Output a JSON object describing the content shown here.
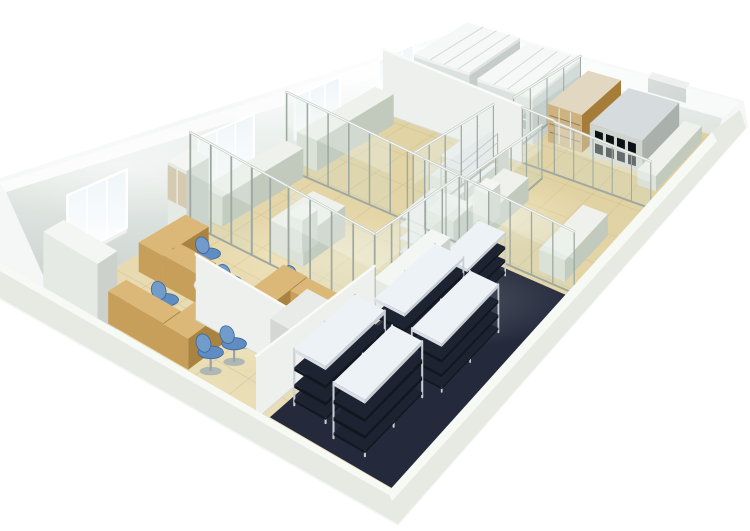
{
  "meta": {
    "title": "3D laboratory floor plan rendering",
    "description": "Isometric cutaway 3D rendering of a long rectangular laboratory suite: office area with wooden desks and blue swivel chairs at the near end, glass-partitioned lab rooms with white benches in the middle, storage room with shelving racks on dark flooring at the front, and fume hoods with reagent cabinets in the far room. White outer walls with windows, beige tiled floor."
  },
  "palette": {
    "background": "#ffffff",
    "shell": "#f5f7f6",
    "wallTopStrip": "#fafbfa",
    "frontWall": "#e4e7df",
    "frontWallStrip": "#f6f8f4",
    "grout": "#c9bc8e",
    "darkFloor": "#242a3c",
    "glass": "rgba(198,219,211,0.20)",
    "glassHighlight": "rgba(255,255,255,0.25)",
    "alum": "#9fa9a1",
    "alumLight": "#ccd3cb",
    "windowPaneTop": "#eef5f9",
    "windowFrame": "#ffffff",
    "windowSill": "#eff2ee",
    "mats": {
      "counter": {
        "top": "#eef1ec",
        "front": "#dfe4da",
        "side": "#c2c9bd"
      },
      "white": {
        "top": "#f4f6f3",
        "front": "#e6eae4",
        "side": "#ccd2cb"
      },
      "wood": {
        "top": "#dcb878",
        "front": "#c79e5a",
        "side": "#a9833f"
      },
      "granite": {
        "top": "#e9ebe9",
        "front": "#d4d7d4",
        "side": "#bec2be"
      },
      "red": {
        "top": "#d84f3a",
        "front": "#bb2d1d",
        "side": "#8f1f13"
      },
      "hood": {
        "top": "#edf0ef",
        "front": "#dce2e0",
        "side": "#c5ccca"
      },
      "woodcab": {
        "top": "#e2d7c0",
        "front": "#c49a52",
        "side": "#a57d38"
      },
      "darkcab": {
        "top": "#d6dbdd",
        "front": "#cfd4cf",
        "side": "#aab0ab"
      },
      "wall": {
        "face": "#eef0ed"
      }
    },
    "rack": {
      "post": "#c6ced6",
      "dark": "#1d2331",
      "darkFront": "#12161f",
      "top": "#edf2f6",
      "topFront": "#d9dfe4"
    },
    "shelf": {
      "post": "#aeb6af",
      "slabTop": "#eceff0",
      "slabFront": "#d7ddda",
      "slabSide": "#c3cac6"
    },
    "chair": {
      "seat": "#5f8cc2",
      "back": "#719bcb",
      "rim": "#3e6598",
      "base": "#a9b2b4",
      "post": "#98a2a2"
    },
    "compartment": "#0d1014"
  },
  "scene": {
    "quad": {
      "L": [
        55,
        302
      ],
      "T": [
        465,
        66
      ],
      "R": [
        716,
        136
      ],
      "B": [
        390,
        498
      ]
    },
    "scale": {
      "k0": 46,
      "ks": 26,
      "kt": 6
    },
    "tiles": {
      "long": 14,
      "cross": 10
    },
    "dark_floor": {
      "s1": 0.02,
      "t1": 0.62,
      "s2": 0.555,
      "t2": 1.0
    },
    "windows": [
      {
        "n": "window-1",
        "s1": 0.03,
        "s2": 0.175,
        "h1": 0.8,
        "h2": 2.2
      },
      {
        "n": "window-2",
        "s1": 0.35,
        "s2": 0.485,
        "h1": 0.8,
        "h2": 2.2
      },
      {
        "n": "window-3",
        "s1": 0.585,
        "s2": 0.695,
        "h1": 0.8,
        "h2": 2.2
      },
      {
        "n": "window-4",
        "s1": 0.79,
        "s2": 0.875,
        "h1": 0.8,
        "h2": 2.2
      }
    ],
    "objects": [
      {
        "n": "corner-cabinet",
        "k": "box",
        "c": "white",
        "s": -0.045,
        "t": 0.02,
        "ds": 0.05,
        "dt": 0.16,
        "h": 1.85
      },
      {
        "n": "office-display-cabinet",
        "k": "glasscab",
        "s": 0.275,
        "t": 0.0,
        "ds": 0.055,
        "dt": 0.06,
        "h": 2.0
      },
      {
        "n": "office-desk-1",
        "k": "box",
        "c": "wood",
        "s": 0.02,
        "t": 0.3,
        "ds": 0.12,
        "dt": 0.075,
        "h": 0.74
      },
      {
        "n": "office-desk-1-return",
        "k": "box",
        "c": "wood",
        "s": 0.02,
        "t": 0.135,
        "ds": 0.045,
        "dt": 0.165,
        "h": 0.74
      },
      {
        "n": "office-desk-2",
        "k": "box",
        "c": "wood",
        "s": 0.165,
        "t": 0.05,
        "ds": 0.115,
        "dt": 0.075,
        "h": 0.74
      },
      {
        "n": "office-desk-2-return",
        "k": "box",
        "c": "wood",
        "s": 0.165,
        "t": 0.125,
        "ds": 0.045,
        "dt": 0.11,
        "h": 0.74
      },
      {
        "n": "office-desk-3",
        "k": "box",
        "c": "wood",
        "s": 0.17,
        "t": 0.36,
        "ds": 0.115,
        "dt": 0.075,
        "h": 0.74
      },
      {
        "n": "office-desk-3-return",
        "k": "box",
        "c": "wood",
        "s": 0.24,
        "t": 0.435,
        "ds": 0.045,
        "dt": 0.1,
        "h": 0.74
      },
      {
        "n": "round-table",
        "k": "roundtable",
        "s": 0.165,
        "t": 0.285,
        "r": 0.5
      },
      {
        "n": "office-sideboard",
        "k": "box",
        "c": "granite",
        "s": 0.13,
        "t": 0.5,
        "ds": 0.1,
        "dt": 0.13,
        "h": 1.12
      },
      {
        "n": "office-chair-1",
        "k": "chair",
        "s": 0.045,
        "t": 0.13
      },
      {
        "n": "office-chair-2",
        "k": "chair",
        "s": 0.095,
        "t": 0.22
      },
      {
        "n": "office-chair-3",
        "k": "chair",
        "s": 0.19,
        "t": 0.16
      },
      {
        "n": "office-chair-4",
        "k": "chair",
        "s": 0.245,
        "t": 0.17
      },
      {
        "n": "office-chair-5",
        "k": "chair",
        "s": 0.04,
        "t": 0.42
      },
      {
        "n": "office-chair-6",
        "k": "chair",
        "s": 0.085,
        "t": 0.44
      },
      {
        "n": "office-chair-7",
        "k": "chair",
        "s": 0.13,
        "t": 0.42
      },
      {
        "n": "office-chair-8",
        "k": "chair",
        "s": 0.19,
        "t": 0.48
      },
      {
        "n": "office-chair-9",
        "k": "chair",
        "s": 0.245,
        "t": 0.5
      },
      {
        "n": "office-chair-10",
        "k": "chair",
        "s": 0.285,
        "t": 0.4
      },
      {
        "n": "office-chair-11",
        "k": "chair",
        "s": 0.13,
        "t": 0.33
      },
      {
        "n": "office-chair-12",
        "k": "chair",
        "s": 0.21,
        "t": 0.28
      },
      {
        "n": "wall-counter-1",
        "k": "box",
        "c": "counter",
        "s": 0.36,
        "t": 0.0,
        "ds": 0.2,
        "dt": 0.065,
        "h": 0.88
      },
      {
        "n": "wall-counter-2",
        "k": "box",
        "c": "counter",
        "s": 0.59,
        "t": 0.0,
        "ds": 0.19,
        "dt": 0.07,
        "h": 1.1
      },
      {
        "n": "island-bench-1",
        "k": "box",
        "c": "counter",
        "s": 0.36,
        "t": 0.22,
        "ds": 0.11,
        "dt": 0.11,
        "h": 0.9
      },
      {
        "n": "island-sink-unit",
        "k": "box",
        "c": "white",
        "s": 0.385,
        "t": 0.245,
        "ds": 0.04,
        "dt": 0.05,
        "h": 1.0
      },
      {
        "n": "storage-cabinet-row",
        "k": "box",
        "c": "white",
        "s": 0.34,
        "t": 0.585,
        "ds": 0.16,
        "dt": 0.065,
        "h": 1.05
      },
      {
        "n": "storage-tall-cabinet",
        "k": "box",
        "c": "white",
        "s": 0.5,
        "t": 0.57,
        "ds": 0.055,
        "dt": 0.09,
        "h": 1.75
      },
      {
        "n": "storage-rack-1",
        "k": "rack",
        "s": 0.07,
        "t": 0.64,
        "ds": 0.17,
        "dt": 0.095
      },
      {
        "n": "storage-rack-2",
        "k": "rack",
        "s": 0.27,
        "t": 0.67,
        "ds": 0.17,
        "dt": 0.095
      },
      {
        "n": "storage-rack-3",
        "k": "rack",
        "s": 0.05,
        "t": 0.78,
        "ds": 0.17,
        "dt": 0.095
      },
      {
        "n": "storage-rack-4",
        "k": "rack",
        "s": 0.25,
        "t": 0.81,
        "ds": 0.17,
        "dt": 0.095
      },
      {
        "n": "storage-rack-5",
        "k": "rack",
        "s": 0.43,
        "t": 0.7,
        "ds": 0.11,
        "dt": 0.09
      },
      {
        "n": "island-bench-2",
        "k": "box",
        "c": "counter",
        "s": 0.64,
        "t": 0.4,
        "ds": 0.13,
        "dt": 0.11,
        "h": 0.9
      },
      {
        "n": "reagent-shelf-riser",
        "k": "openshelf",
        "s": 0.655,
        "t": 0.42,
        "ds": 0.1,
        "dt": 0.07,
        "h": 1.6
      },
      {
        "n": "open-shelf-unit",
        "k": "openshelf",
        "s": 0.47,
        "t": 0.515,
        "ds": 0.09,
        "dt": 0.08,
        "h": 1.6
      },
      {
        "n": "side-bench-right",
        "k": "box",
        "c": "counter",
        "s": 0.6,
        "t": 0.56,
        "ds": 0.12,
        "dt": 0.09,
        "h": 0.9
      },
      {
        "n": "instrument-unit",
        "k": "box",
        "c": "white",
        "s": 0.625,
        "t": 0.575,
        "ds": 0.035,
        "dt": 0.05,
        "h": 1.3
      },
      {
        "n": "front-bench-right",
        "k": "box",
        "c": "counter",
        "s": 0.58,
        "t": 0.86,
        "ds": 0.13,
        "dt": 0.09,
        "h": 0.9
      },
      {
        "n": "far-wall-bench",
        "k": "box",
        "c": "counter",
        "s": 0.82,
        "t": 0.0,
        "ds": 0.16,
        "dt": 0.06,
        "h": 0.9
      },
      {
        "n": "emergency-eyewash",
        "k": "box",
        "c": "red",
        "s": 0.838,
        "t": 0.005,
        "ds": 0.02,
        "dt": 0.028,
        "h": 1.3
      },
      {
        "n": "fume-hood-1",
        "k": "hood",
        "s": 0.85,
        "t": 0.04,
        "ds": 0.13,
        "dt": 0.21,
        "h": 2.25
      },
      {
        "n": "fume-hood-2",
        "k": "hood",
        "s": 0.85,
        "t": 0.28,
        "ds": 0.13,
        "dt": 0.21,
        "h": 2.25
      },
      {
        "n": "reagent-cabinet-wood",
        "k": "woodcab",
        "s": 0.87,
        "t": 0.52,
        "ds": 0.11,
        "dt": 0.13,
        "h": 2.05
      },
      {
        "n": "chemical-cabinet-dark",
        "k": "darkcab",
        "s": 0.87,
        "t": 0.68,
        "ds": 0.11,
        "dt": 0.2,
        "h": 1.85
      },
      {
        "n": "far-front-bench",
        "k": "box",
        "c": "counter",
        "s": 0.84,
        "t": 0.9,
        "ds": 0.14,
        "dt": 0.07,
        "h": 0.9
      },
      {
        "n": "office-divider-wall",
        "k": "partition",
        "style": "solid",
        "s1": 0.13,
        "t1": 0.27,
        "s2": 0.13,
        "t2": 0.6,
        "h": 1.6
      },
      {
        "n": "office-front-wall",
        "k": "partition",
        "style": "solid",
        "s1": 0.0,
        "t1": 0.6,
        "s2": 0.33,
        "t2": 0.6,
        "h": 1.5
      },
      {
        "n": "storage-north-partition",
        "k": "partition",
        "style": "glass",
        "posts": 5,
        "s1": 0.33,
        "t1": 0.6,
        "s2": 0.565,
        "t2": 0.6,
        "h": 2.45
      },
      {
        "n": "office-lab-partition-a",
        "k": "partition",
        "style": "glass",
        "posts": 3,
        "s1": 0.33,
        "t1": 0.0,
        "s2": 0.33,
        "t2": 0.2,
        "h": 2.45
      },
      {
        "n": "office-lab-door",
        "k": "partition",
        "style": "frame",
        "s1": 0.33,
        "t1": 0.2,
        "s2": 0.33,
        "t2": 0.32,
        "h": 2.45
      },
      {
        "n": "office-lab-partition-b",
        "k": "partition",
        "style": "glass",
        "posts": 4,
        "s1": 0.33,
        "t1": 0.32,
        "s2": 0.33,
        "t2": 0.6,
        "h": 2.45
      },
      {
        "n": "mid-partition-a",
        "k": "partition",
        "style": "glass",
        "posts": 5,
        "s1": 0.565,
        "t1": 0.0,
        "s2": 0.565,
        "t2": 0.36,
        "h": 2.45
      },
      {
        "n": "mid-door",
        "k": "partition",
        "style": "frame",
        "s1": 0.565,
        "t1": 0.36,
        "s2": 0.565,
        "t2": 0.48,
        "h": 2.45
      },
      {
        "n": "mid-partition-b",
        "k": "partition",
        "style": "glass",
        "posts": 7,
        "s1": 0.565,
        "t1": 0.48,
        "s2": 0.565,
        "t2": 1.0,
        "h": 2.45
      },
      {
        "n": "far-room-wall",
        "k": "partition",
        "style": "solid",
        "s1": 0.8,
        "t1": 0.0,
        "s2": 0.8,
        "t2": 0.52,
        "h": 2.55
      },
      {
        "n": "far-room-door",
        "k": "partition",
        "style": "frame",
        "s1": 0.8,
        "t1": 0.52,
        "s2": 0.8,
        "t2": 0.64,
        "h": 2.5
      },
      {
        "n": "far-room-partition",
        "k": "partition",
        "style": "glass",
        "posts": 5,
        "s1": 0.8,
        "t1": 0.64,
        "s2": 0.8,
        "t2": 1.0,
        "h": 2.45
      },
      {
        "n": "right-long-partition-a",
        "k": "partition",
        "style": "glass",
        "posts": 5,
        "s1": 0.565,
        "t1": 0.44,
        "s2": 0.78,
        "t2": 0.44,
        "h": 2.45
      },
      {
        "n": "right-long-partition-b",
        "k": "partition",
        "style": "glass",
        "posts": 4,
        "s1": 0.82,
        "t1": 0.46,
        "s2": 1.0,
        "t2": 0.46,
        "h": 2.45
      },
      {
        "n": "right-low-partition",
        "k": "partition",
        "style": "glass",
        "posts": 5,
        "s1": 0.565,
        "t1": 0.62,
        "s2": 0.78,
        "t2": 0.62,
        "h": 2.45
      }
    ]
  }
}
